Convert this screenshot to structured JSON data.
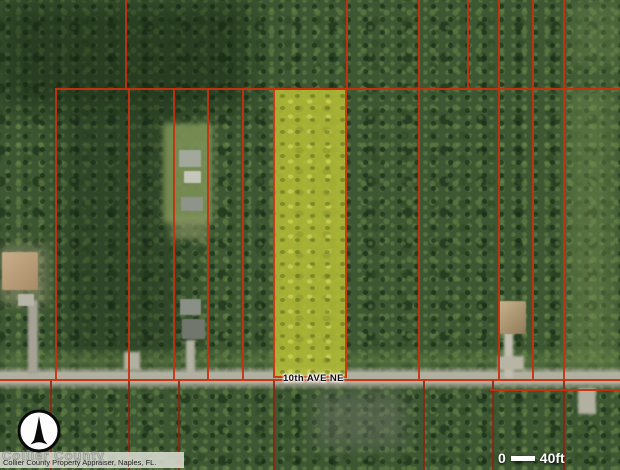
{
  "map": {
    "street_label": "10th AVE NE",
    "attribution": "Collier County Property Appraiser, Naples, FL.",
    "watermark": "Collier County",
    "scale": {
      "start": "0",
      "end": "40ft"
    },
    "compass": "north-arrow",
    "colors": {
      "parcel_line": "#c7310f",
      "parcel_line_dark": "#8f2210",
      "highlight_fill": "#b4bd35",
      "highlight_border": "#cb3a12",
      "road": "#b3b1a1",
      "forest_base": "#3c5732"
    },
    "highlight_parcel": {
      "x": 273,
      "y": 88,
      "w": 74,
      "h": 290
    },
    "lines": {
      "horizontal_mid_y": 88,
      "horizontal_mid_x0": 55,
      "road_line_y": 379,
      "road_line2": {
        "x0": 490,
        "y": 389
      },
      "verticals_upper": [
        125,
        346,
        418,
        467,
        498,
        532,
        563
      ],
      "verticals_lower": [
        55,
        128,
        173,
        207,
        242,
        418,
        498,
        532,
        563
      ],
      "verticals_below_road": [
        50,
        128,
        178,
        273,
        423,
        492,
        563
      ]
    },
    "patches": [
      {
        "name": "dark-canopy",
        "x": 0,
        "y": 0,
        "w": 250,
        "h": 110,
        "color": "rgba(15,30,14,.45)",
        "blur": 12
      },
      {
        "name": "dark-canopy",
        "x": 60,
        "y": 100,
        "w": 120,
        "h": 260,
        "color": "rgba(20,38,20,.35)",
        "blur": 14
      },
      {
        "name": "light-canopy-strip",
        "x": 566,
        "y": 85,
        "w": 48,
        "h": 285,
        "color": "rgba(125,150,85,.40)",
        "blur": 8
      },
      {
        "name": "light-canopy",
        "x": 570,
        "y": 0,
        "w": 50,
        "h": 70,
        "color": "rgba(120,145,85,.35)",
        "blur": 8
      },
      {
        "name": "clearing-lawn",
        "x": 163,
        "y": 123,
        "w": 50,
        "h": 100,
        "color": "rgba(122,143,85,.92)",
        "blur": 3
      },
      {
        "name": "clearing-lawn",
        "x": 170,
        "y": 215,
        "w": 38,
        "h": 25,
        "color": "rgba(140,150,100,.6)",
        "blur": 4
      },
      {
        "name": "left-yard",
        "x": 0,
        "y": 245,
        "w": 48,
        "h": 60,
        "color": "rgba(150,150,115,.55)",
        "blur": 6
      },
      {
        "name": "grass-shoulder",
        "x": 0,
        "y": 354,
        "w": 620,
        "h": 13,
        "color": "rgba(105,135,75,.5)",
        "blur": 4
      },
      {
        "name": "gray-trees",
        "x": 315,
        "y": 392,
        "w": 90,
        "h": 55,
        "color": "rgba(115,120,108,.45)",
        "blur": 9
      }
    ],
    "driveways": [
      {
        "x": 28,
        "y": 300,
        "w": 10,
        "h": 74,
        "color": "#a6a396"
      },
      {
        "x": 124,
        "y": 352,
        "w": 16,
        "h": 18,
        "color": "#b2b0a0"
      },
      {
        "x": 186,
        "y": 340,
        "w": 9,
        "h": 34,
        "color": "#b2b0a0"
      },
      {
        "x": 504,
        "y": 332,
        "w": 9,
        "h": 46,
        "color": "#c2bfb0"
      },
      {
        "x": 498,
        "y": 356,
        "w": 26,
        "h": 14,
        "color": "#b8b5a5"
      },
      {
        "x": 578,
        "y": 388,
        "w": 18,
        "h": 26,
        "color": "#b2b0a0"
      }
    ],
    "houses": [
      {
        "name": "house",
        "x": 2,
        "y": 252,
        "w": 36,
        "h": 38,
        "color": "linear-gradient(135deg,#c9ae8c,#a98c66)"
      },
      {
        "name": "shed",
        "x": 18,
        "y": 294,
        "w": 16,
        "h": 12,
        "color": "#b7b4a8"
      },
      {
        "name": "house",
        "x": 179,
        "y": 150,
        "w": 22,
        "h": 17,
        "color": "#a3a89c"
      },
      {
        "name": "house",
        "x": 184,
        "y": 171,
        "w": 17,
        "h": 12,
        "color": "#c6c7bb"
      },
      {
        "name": "shed",
        "x": 181,
        "y": 197,
        "w": 22,
        "h": 14,
        "color": "#8f948a"
      },
      {
        "name": "house",
        "x": 180,
        "y": 299,
        "w": 21,
        "h": 16,
        "color": "#8b9087"
      },
      {
        "name": "house",
        "x": 182,
        "y": 319,
        "w": 23,
        "h": 20,
        "color": "#72776e"
      },
      {
        "name": "house",
        "x": 499,
        "y": 301,
        "w": 27,
        "h": 33,
        "color": "linear-gradient(135deg,#c9b28c,#8f7a58)"
      }
    ]
  }
}
